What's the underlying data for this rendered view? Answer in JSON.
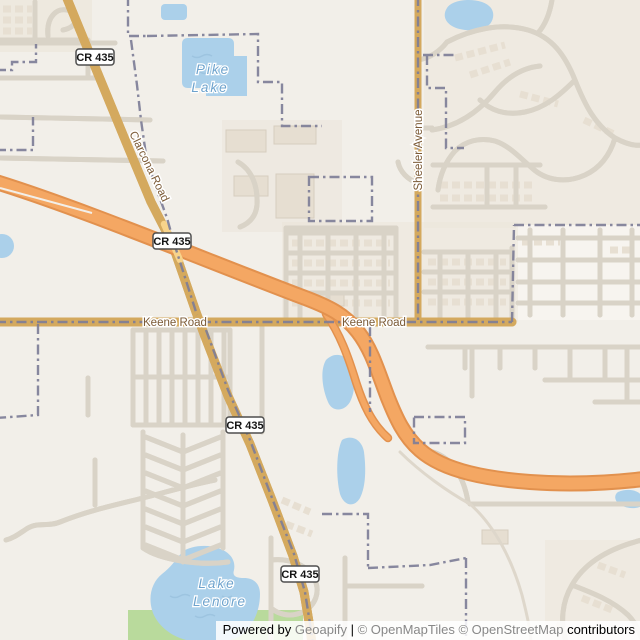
{
  "map": {
    "water_labels": {
      "pike_lake": {
        "line1": "Pike",
        "line2": "Lake"
      },
      "lake_lenore": {
        "line1": "Lake",
        "line2": "Lenore"
      }
    },
    "road_labels": {
      "clarcona": "Clarcona Road",
      "sheeler": "Sheeler Avenue",
      "keene_west": "Keene Road",
      "keene_east": "Keene Road"
    },
    "shields": [
      {
        "label": "CR 435"
      },
      {
        "label": "CR 435"
      },
      {
        "label": "CR 435"
      },
      {
        "label": "CR 435"
      }
    ],
    "colors": {
      "background": "#f2efe9",
      "residential": "#ece5da",
      "industrial": "#e9e2d7",
      "building": "#e6ded1",
      "park_green": "#b9da9c",
      "water": "#abd0ea",
      "water_label": "#6ea3cd",
      "minor_road": "#ffffff",
      "minor_road_casing": "#d9d3c7",
      "secondary_road": "#f7d38b",
      "secondary_casing": "#d4a95e",
      "motorway": "#f4a763",
      "motorway_casing": "#e2914e",
      "boundary": "#7e7e97",
      "road_label": "#7b5a36",
      "shield_border": "#4f4f4f",
      "shield_text": "#111111"
    }
  },
  "attribution": {
    "powered_by": "Powered by",
    "brand": "Geoapify",
    "separator": "|",
    "tiles_credit": "© OpenMapTiles",
    "osm_credit": "© OpenStreetMap",
    "suffix": "contributors"
  }
}
